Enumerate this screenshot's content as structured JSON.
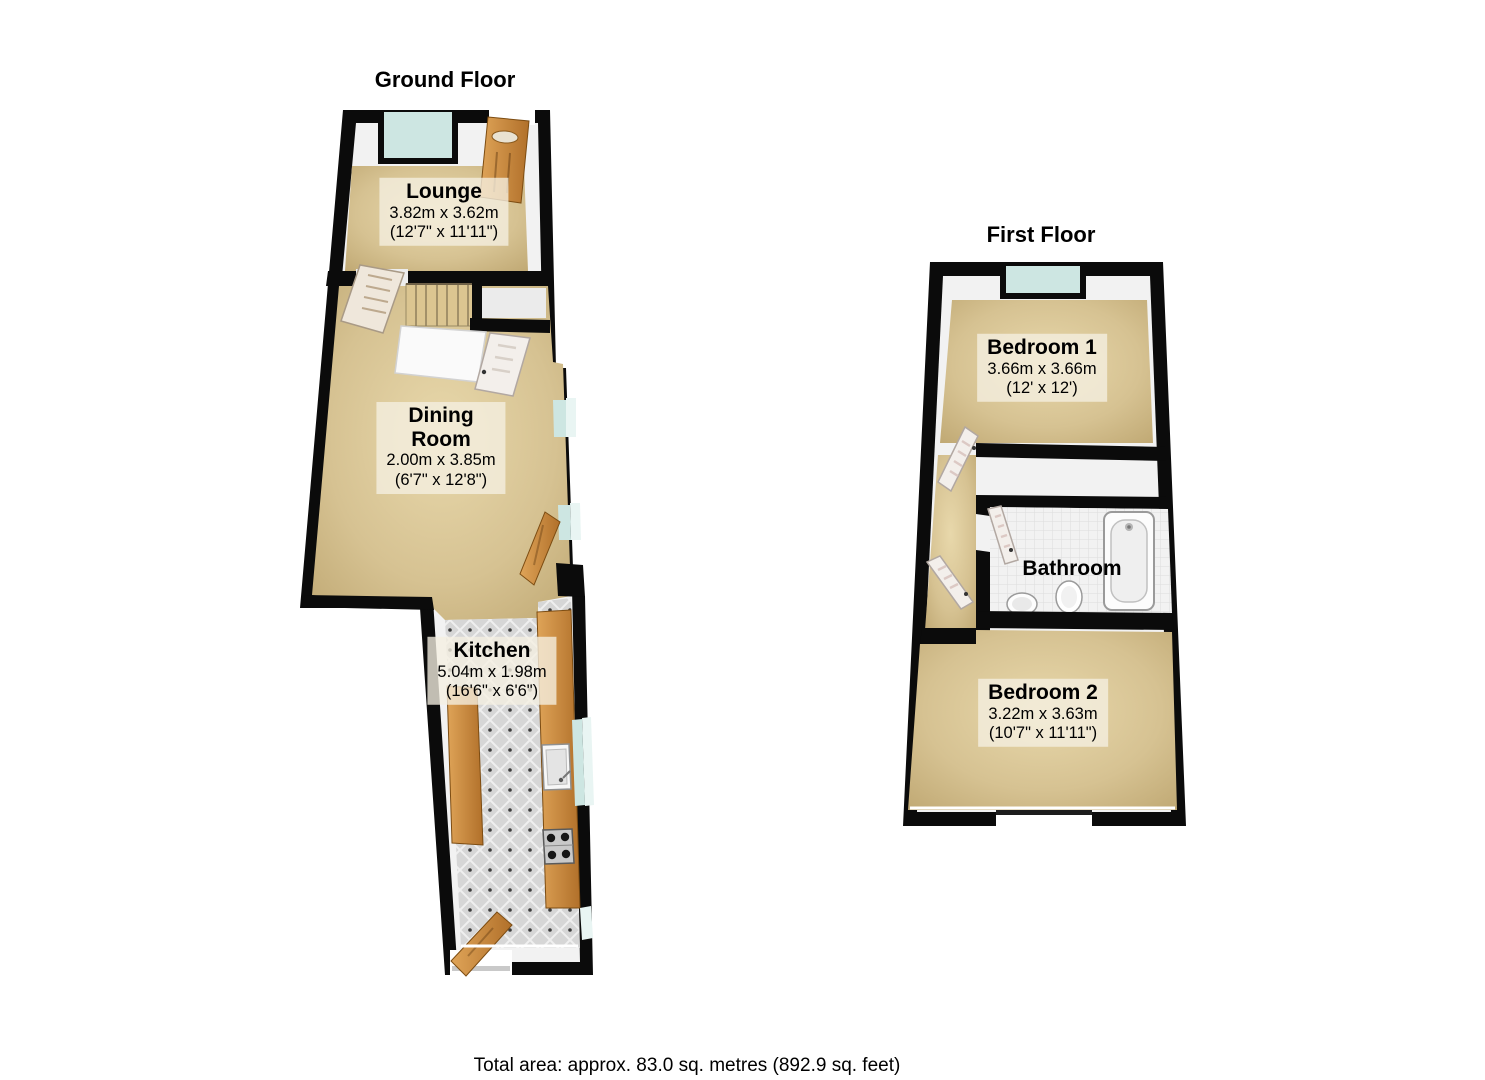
{
  "ground": {
    "title": "Ground Floor",
    "rooms": {
      "lounge": {
        "name": "Lounge",
        "metric": "3.82m x 3.62m",
        "imperial": "(12'7\" x 11'11\")"
      },
      "dining": {
        "name_line1": "Dining",
        "name_line2": "Room",
        "metric": "2.00m x 3.85m",
        "imperial": "(6'7\" x 12'8\")"
      },
      "kitchen": {
        "name": "Kitchen",
        "metric": "5.04m x 1.98m",
        "imperial": "(16'6\" x 6'6\")"
      }
    }
  },
  "first": {
    "title": "First Floor",
    "rooms": {
      "bedroom1": {
        "name": "Bedroom 1",
        "metric": "3.66m x 3.66m",
        "imperial": "(12' x 12')"
      },
      "bathroom": {
        "name": "Bathroom"
      },
      "bedroom2": {
        "name": "Bedroom 2",
        "metric": "3.22m x 3.63m",
        "imperial": "(10'7\" x 11'11\")"
      }
    }
  },
  "footer": {
    "total_area": "Total area: approx. 83.0 sq. metres (892.9 sq. feet)"
  },
  "colors": {
    "wall": "#0b0b0b",
    "carpet": "#d6c292",
    "window_glass": "#cde6e2",
    "door_wood": "#c0813a",
    "kitchen_tile": "#d6d6d6",
    "bath_tile": "#f2f2f2",
    "label_bg": "#f5efe2",
    "text": "#000000"
  }
}
